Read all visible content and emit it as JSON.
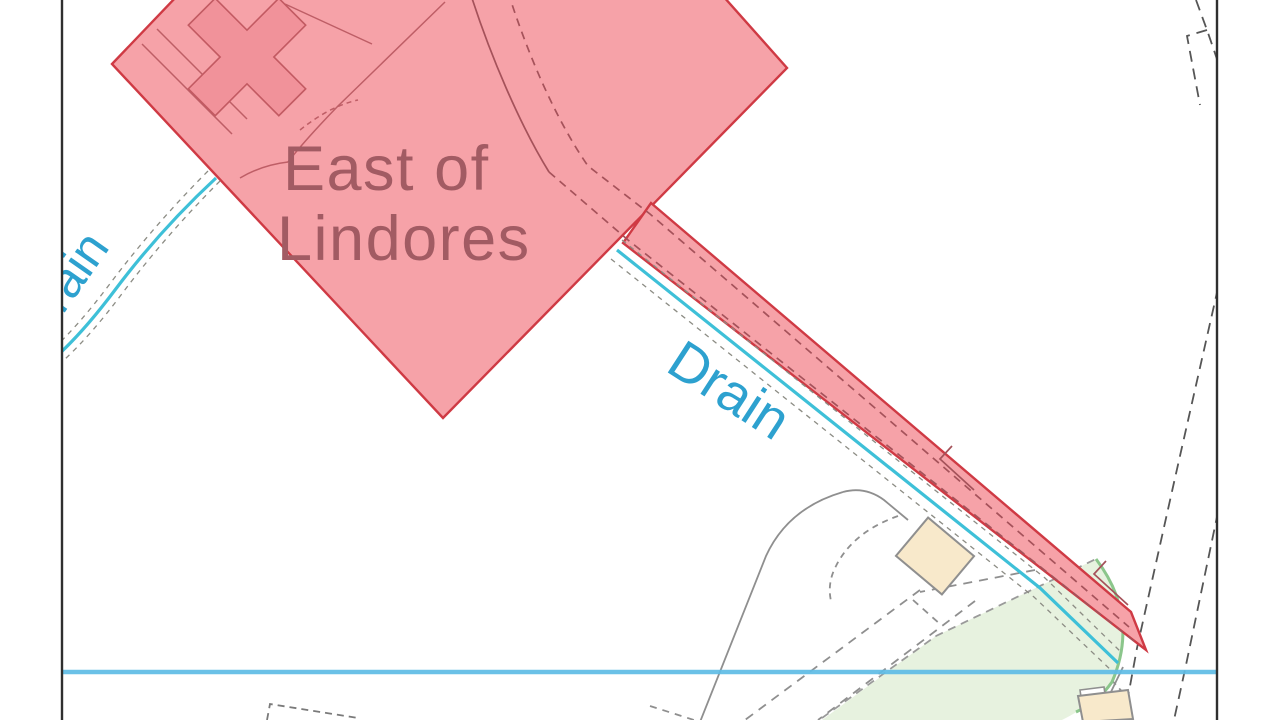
{
  "map": {
    "place_label": {
      "line1": "East of",
      "line2": "Lindores"
    },
    "drain_label_main": "Drain",
    "drain_label_left": "Drain",
    "colors": {
      "site_boundary_red": "#cf3a44",
      "site_fill_pink": "#f6a2a8",
      "cross_building_fill": "#f1929a",
      "place_label_brown": "#a25b63",
      "drain_text_blue": "#2da1cf",
      "drain_line_cyan": "#3ec0d8",
      "section_line_blue": "#5fbce6",
      "map_border_black": "#2f2f2f",
      "base_line_gray": "#8f8f8f",
      "building_beige": "#f8e9cb",
      "field_green_fill": "#e7f2df",
      "field_green_stroke": "#8bc68b",
      "track_dash_dark_red": "#a5525a"
    }
  }
}
